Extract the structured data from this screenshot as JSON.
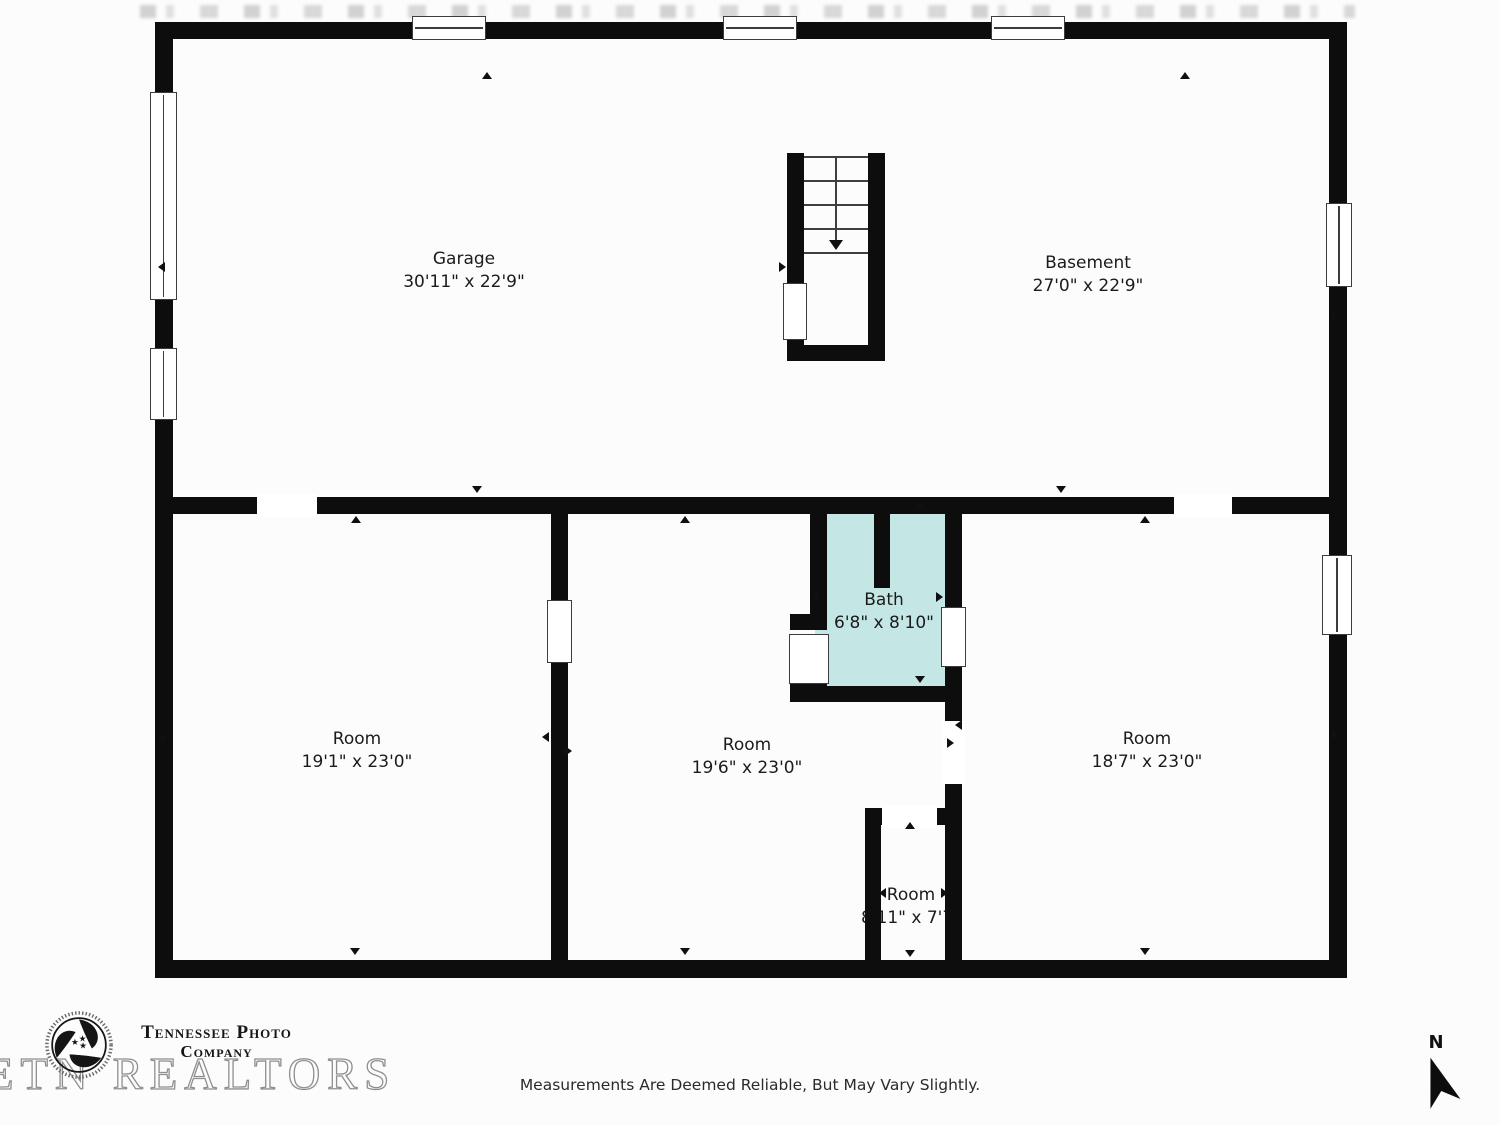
{
  "plan": {
    "rooms": [
      {
        "name": "Garage",
        "dims": "30'11\" x 22'9\""
      },
      {
        "name": "Basement",
        "dims": "27'0\" x 22'9\""
      },
      {
        "name": "Bath",
        "dims": "6'8\" x 8'10\""
      },
      {
        "name": "Room",
        "dims": "19'1\" x 23'0\""
      },
      {
        "name": "Room",
        "dims": "19'6\" x 23'0\""
      },
      {
        "name": "Room",
        "dims": "18'7\" x 23'0\""
      },
      {
        "name": "Room",
        "dims": "8'11\" x 7'7\""
      }
    ],
    "colors": {
      "wall": "#0d0d0d",
      "bath_fill": "#c4e7e6",
      "background": "#fcfcfc"
    }
  },
  "branding": {
    "logo_line1": "Tennessee Photo",
    "logo_line2": "Company",
    "watermark": "ETN REALTORS"
  },
  "footer": {
    "disclaimer": "Measurements Are Deemed Reliable, But May Vary Slightly."
  },
  "compass": {
    "label": "N"
  }
}
